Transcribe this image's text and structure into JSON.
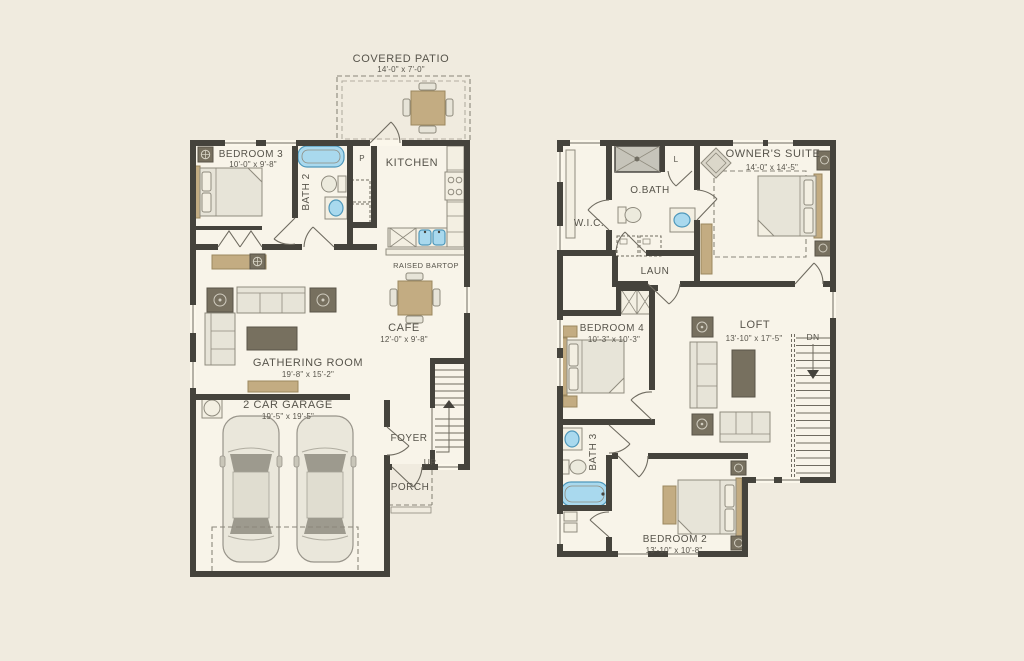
{
  "palette": {
    "background": "#f0ebdf",
    "floor": "#f8f4e9",
    "wall": "#45433c",
    "text": "#57544b",
    "fixture_blue": "#a9d9ee",
    "furniture_tan": "#c3ac82",
    "furniture_dark": "#77705f"
  },
  "floor1": {
    "patio": {
      "name": "COVERED PATIO",
      "dims": "14'-0\" x 7'-0\""
    },
    "bedroom3": {
      "name": "BEDROOM 3",
      "dims": "10'-0\" x 9'-8\""
    },
    "bath2": {
      "name": "BATH 2"
    },
    "kitchen": {
      "name": "KITCHEN"
    },
    "pantry": {
      "name": "P"
    },
    "bartop": {
      "name": "RAISED BARTOP"
    },
    "cafe": {
      "name": "CAFE",
      "dims": "12'-0\" x 9'-8\""
    },
    "gathering": {
      "name": "GATHERING ROOM",
      "dims": "19'-8\" x 15'-2\""
    },
    "garage": {
      "name": "2 CAR GARAGE",
      "dims": "19'-5\" x 19'-5\""
    },
    "foyer": {
      "name": "FOYER"
    },
    "up": {
      "name": "UP"
    },
    "porch": {
      "name": "PORCH"
    }
  },
  "floor2": {
    "wic": {
      "name": "W.I.C."
    },
    "obath": {
      "name": "O.BATH"
    },
    "linen": {
      "name": "L"
    },
    "owners_suite": {
      "name": "OWNER'S SUITE",
      "dims": "14'-0\" x 14'-5\""
    },
    "laundry": {
      "name": "LAUN"
    },
    "bedroom4": {
      "name": "BEDROOM 4",
      "dims": "10'-3\" x 10'-3\""
    },
    "loft": {
      "name": "LOFT",
      "dims": "13'-10\" x 17'-5\""
    },
    "dn": {
      "name": "DN"
    },
    "bath3": {
      "name": "BATH 3"
    },
    "bedroom2": {
      "name": "BEDROOM 2",
      "dims": "13'-10\" x 10'-8\""
    }
  }
}
